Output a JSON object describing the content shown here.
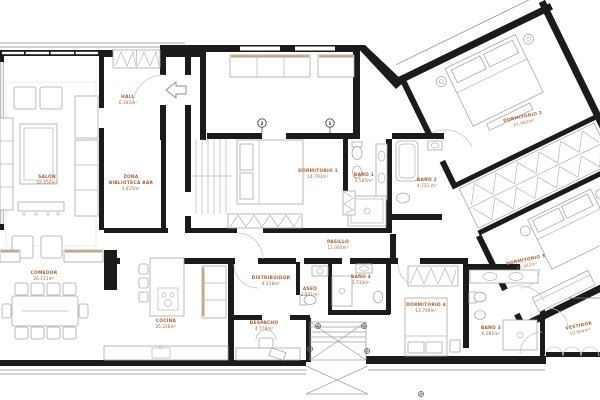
{
  "colors": {
    "wall": "#1b1b1b",
    "furniture_line": "#a9a9a9",
    "label": "#a95c36",
    "cabinet_accent": "#c9a27d"
  },
  "rooms": [
    {
      "name": "HALL",
      "area": "6.305m²"
    },
    {
      "name": "SALÓN",
      "area": "42.456m²"
    },
    {
      "name": "ZONA",
      "name2": "BIBLIOTECA BAR",
      "area": "4.815m²"
    },
    {
      "name": "DORMITORIO 1",
      "area": "14.793m²"
    },
    {
      "name": "BAÑO 1",
      "area": "5.585m²"
    },
    {
      "name": "PASILLO",
      "area": "12.065m²"
    },
    {
      "name": "DORMITORIO 2",
      "area": "21.062m²"
    },
    {
      "name": "BAÑO 2",
      "area": "4.731 m²"
    },
    {
      "name": "DORMITORIO 3",
      "area": "21.052m²"
    },
    {
      "name": "DORMITORIO 4",
      "area": "13.709m²"
    },
    {
      "name": "BAÑO 3",
      "area": "6.081m²"
    },
    {
      "name": "VESTIDOR",
      "area": "10.004m²"
    },
    {
      "name": "DISTRIBUIDOR",
      "area": "4.158m²"
    },
    {
      "name": "ASEO",
      "area": "2.501m²"
    },
    {
      "name": "BAÑO 4",
      "area": "1.730m²"
    },
    {
      "name": "DESPACHO",
      "area": "4.778m²"
    },
    {
      "name": "COMEDOR",
      "area": "26.111m²"
    },
    {
      "name": "COCINA",
      "area": "26.228m²"
    }
  ],
  "markers": [
    {
      "num": "2"
    },
    {
      "num": "1"
    }
  ]
}
